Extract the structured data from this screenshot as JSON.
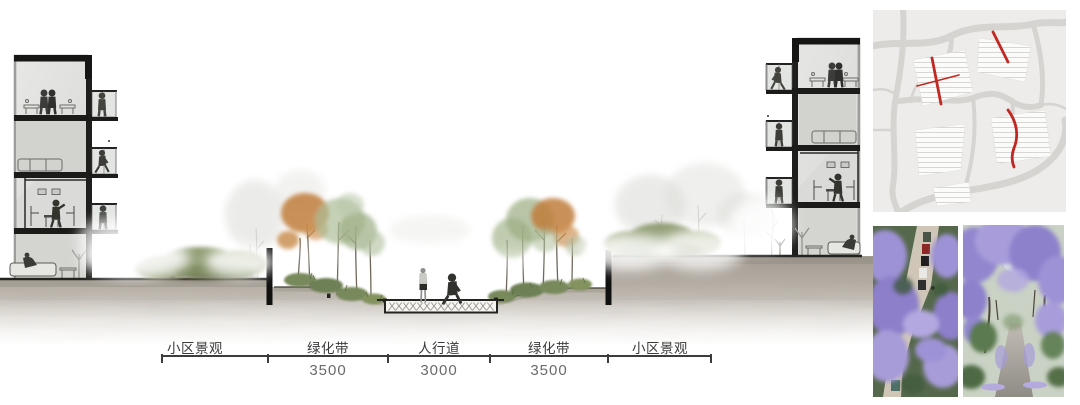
{
  "section_drawing": {
    "segments": [
      {
        "label": "小区景观"
      },
      {
        "label": "绿化带",
        "dimension": "3500"
      },
      {
        "label": "人行道",
        "dimension": "3000"
      },
      {
        "label": "绿化带",
        "dimension": "3500"
      },
      {
        "label": "小区景观"
      }
    ]
  },
  "colors": {
    "accent_red": "#c22823",
    "ground": "#b0a9a0",
    "foliage_green": "#8f9c72",
    "foliage_orange": "#c07e3c",
    "jacaranda_purple": "#9b8ed2",
    "structure_black": "#1c1c1c"
  }
}
